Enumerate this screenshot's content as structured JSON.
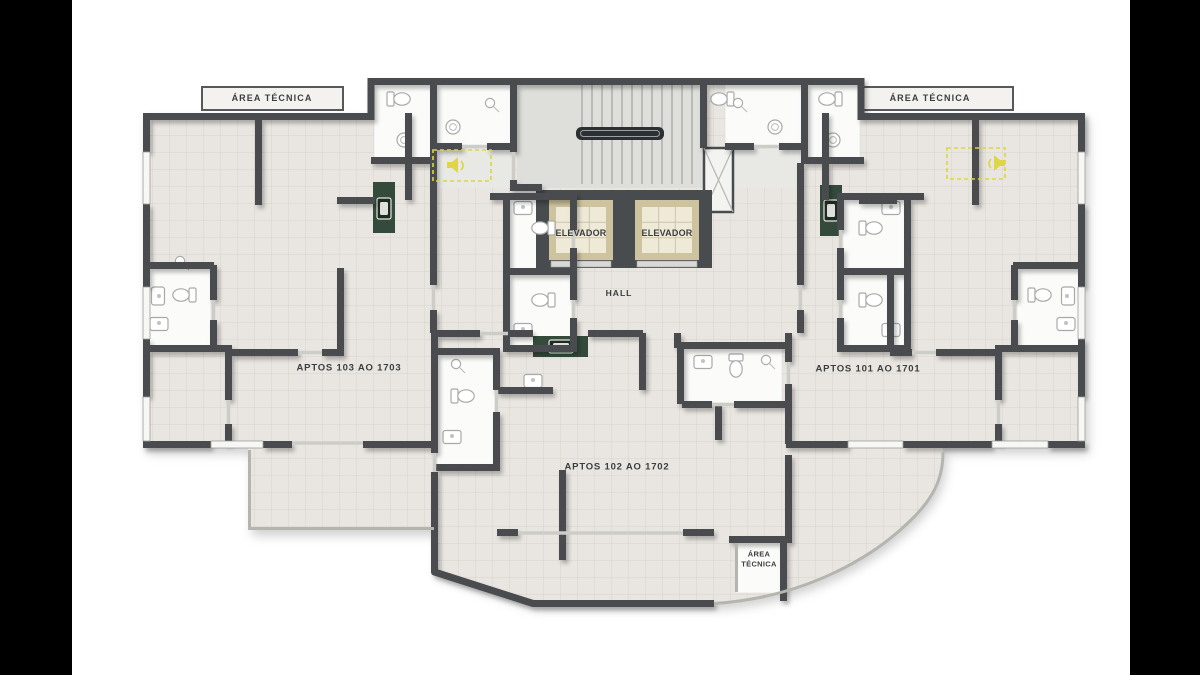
{
  "scene": {
    "type": "architectural-floor-plan",
    "description": "Apartment tower typical floor plan with three units per floor, central stair and elevator core"
  },
  "labels": {
    "area_tecnica_top_left": "ÁREA TÉCNICA",
    "area_tecnica_top_right": "ÁREA TÉCNICA",
    "elevator_left": "ELEVADOR",
    "elevator_right": "ELEVADOR",
    "hall": "HALL",
    "apartment_left": "APTOS 103 AO 1703",
    "apartment_right": "APTOS 101 AO 1701",
    "apartment_bottom": "APTOS 102 AO 1702",
    "area_tecnica_bottom_line1": "ÁREA",
    "area_tecnica_bottom_line2": "TÉCNICA"
  },
  "colors": {
    "letterbox": "#000000",
    "canvas": "#ffffff",
    "wall": "#484c4f",
    "floor": "#e9e6e1",
    "stair_floor": "#dededb",
    "bathroom": "#fbfbfa",
    "elevator_frame": "#cdc39e",
    "elevator_cab": "#efe9d7",
    "counter_green": "#344b3c",
    "sink_dark": "#1d2b22",
    "highlight_yellow": "#ddd53f",
    "text": "#3b3e40",
    "thin_line": "#b5b5b0"
  },
  "icons": {
    "speaker_left": "intercom-speaker-icon",
    "speaker_right": "intercom-speaker-icon"
  }
}
